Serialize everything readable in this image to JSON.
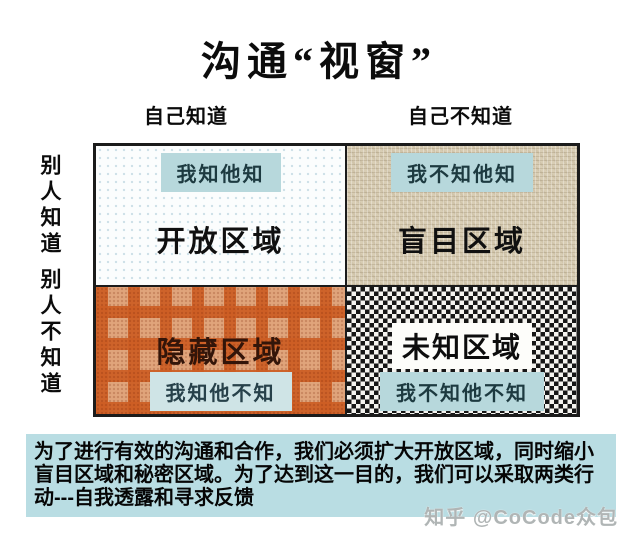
{
  "title": "沟通“视窗”",
  "column_headers": {
    "left": "自己知道",
    "right": "自己不知道"
  },
  "row_headers": {
    "top": "别人知道",
    "bottom": "别人不知道"
  },
  "quadrants": {
    "open": {
      "badge": "我知他知",
      "label": "开放区域"
    },
    "blind": {
      "badge": "我不知他知",
      "label": "盲目区域"
    },
    "hidden": {
      "badge": "我知他不知",
      "label": "隐藏区域"
    },
    "unknown": {
      "badge": "我不知他不知",
      "label": "未知区域"
    }
  },
  "footer_note": "为了进行有效的沟通和合作，我们必须扩大开放区域，同时缩小盲目区域和秘密区域。为了达到这一目的，我们可以采取两类行动---自我透露和寻求反馈",
  "watermark": "知乎 @CoCode众包",
  "colors": {
    "badge_blue": "#b7d8dc",
    "badge_blue_light": "#cfe4e6",
    "note_blue": "#b9dde3",
    "linen_beige": "#d8cdb4",
    "weave_orange_light": "#e0a47b",
    "weave_orange_dark": "#cd5e24",
    "checker_dark": "#161616",
    "checker_light": "#f4f3ef",
    "border_black": "#1b1b1b"
  }
}
